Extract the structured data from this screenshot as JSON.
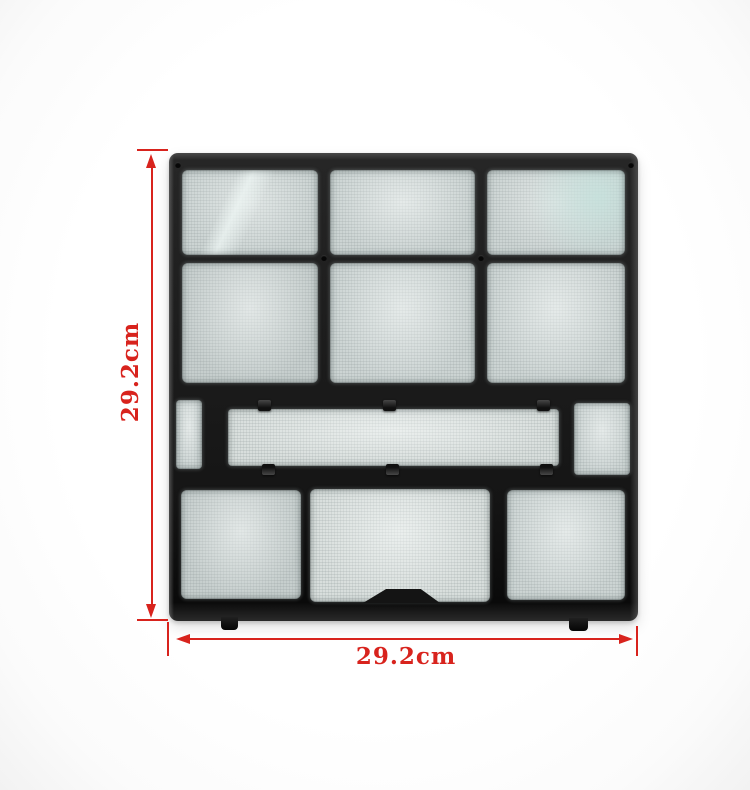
{
  "scene": {
    "subject": "black plastic air-conditioner dust filter panel on white background",
    "background_color": "#ffffff"
  },
  "annotations": {
    "height_label": "29.2cm",
    "width_label": "29.2cm",
    "annotation_color": "#d8231d"
  },
  "product": {
    "frame_color": "#1a1a1a",
    "mesh_color": "#ccd4d3"
  }
}
